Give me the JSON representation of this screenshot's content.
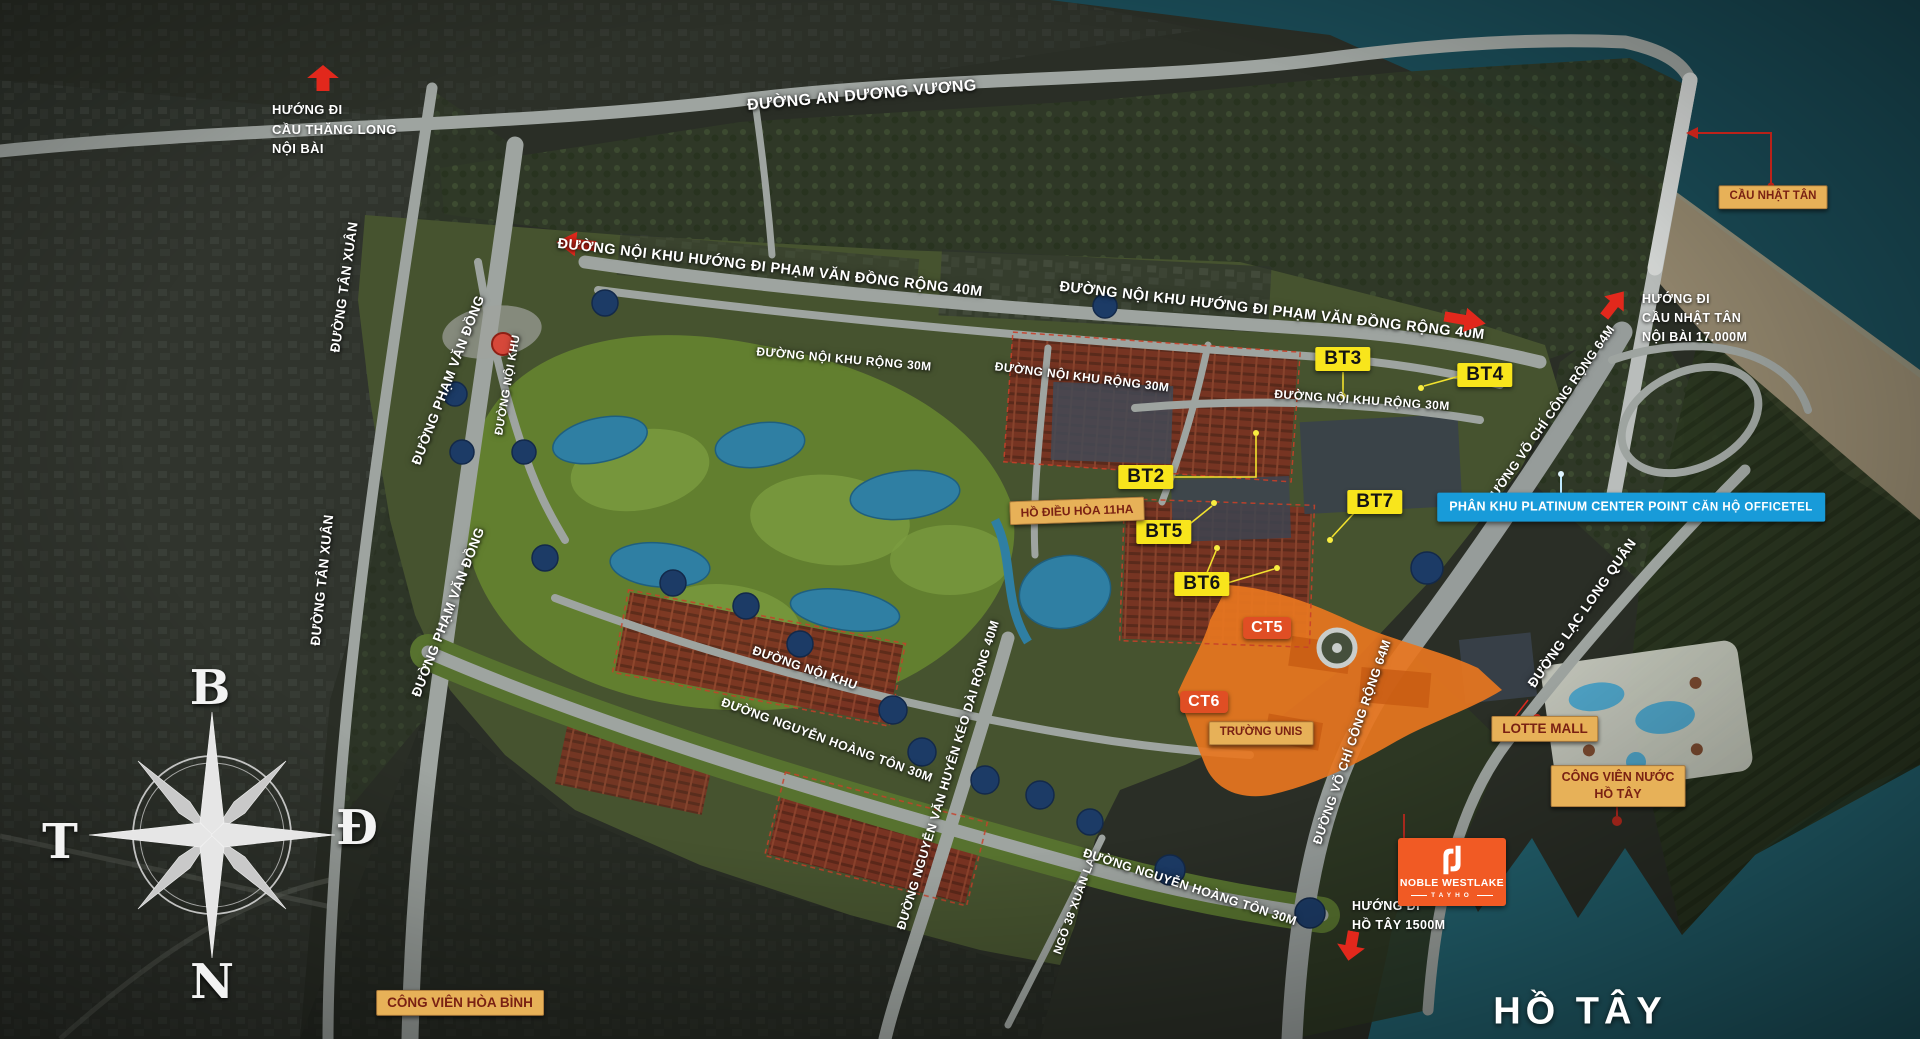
{
  "colors": {
    "badge_tan_bg": "#E7B158",
    "badge_tan_text": "#7A2113",
    "badge_yellow_bg": "#F8E51C",
    "badge_yellow_text": "#141414",
    "badge_blue_bg": "#189BD9",
    "badge_ct_bg": "#E04E24",
    "arrow_red": "#E2281C",
    "noble_orange": "#F15A24",
    "road_text": "#FFFFFF"
  },
  "compass": {
    "north": "B",
    "east": "Đ",
    "south": "N",
    "west": "T"
  },
  "directions": {
    "thang_long": {
      "line1": "HƯỚNG ĐI",
      "line2": "CẦU THĂNG LONG",
      "line3": "NỘI BÀI"
    },
    "nhat_tan": {
      "line1": "HƯỚNG ĐI",
      "line2": "CẦU NHẬT TÂN",
      "line3": "NỘI BÀI 17.000M"
    },
    "ho_tay": {
      "line1": "HƯỚNG ĐI",
      "line2": "HỒ TÂY 1500M"
    }
  },
  "roads": {
    "an_duong_vuong": "ĐƯỜNG AN DƯƠNG VƯƠNG",
    "noi_khu_40m_tay": "ĐƯỜNG NỘI KHU HƯỚNG ĐI PHẠM VĂN ĐỒNG RỘNG 40M",
    "noi_khu_40m_dong": "ĐƯỜNG NỘI KHU HƯỚNG ĐI PHẠM VĂN ĐỒNG RỘNG 40M",
    "noi_khu_30m_1": "ĐƯỜNG NỘI KHU RỘNG 30M",
    "noi_khu_30m_2": "ĐƯỜNG NỘI KHU RỘNG 30M",
    "noi_khu_30m_3": "ĐƯỜNG NỘI KHU RỘNG 30M",
    "tan_xuan_1": "ĐƯỜNG TÂN XUÂN",
    "tan_xuan_2": "ĐƯỜNG TÂN XUÂN",
    "pham_van_dong_1": "ĐƯỜNG PHẠM VĂN ĐỒNG",
    "pham_van_dong_2": "ĐƯỜNG PHẠM VĂN ĐỒNG",
    "noi_khu_doc": "ĐƯỜNG NỘI KHU",
    "noi_khu_nam": "ĐƯỜNG NỘI KHU",
    "nguyen_hoang_ton_1": "ĐƯỜNG NGUYỄN HOÀNG TÔN 30M",
    "nguyen_hoang_ton_2": "ĐƯỜNG NGUYỄN HOÀNG TÔN 30M",
    "nguyen_van_huyen": "ĐƯỜNG NGUYỄN VĂN HUYÊN KÉO DÀI RỘNG 40M",
    "ngo_38_xuan_la": "NGÕ 38 XUÂN LA",
    "vo_chi_cong_1": "ĐƯỜNG VÕ CHÍ CÔNG RỘNG 64M",
    "vo_chi_cong_2": "ĐƯỜNG VÕ CHÍ CÔNG RỘNG 64M",
    "lac_long_quan": "ĐƯỜNG LẠC LONG QUÂN"
  },
  "plots": {
    "bt2": "BT2",
    "bt3": "BT3",
    "bt4": "BT4",
    "bt5": "BT5",
    "bt6": "BT6",
    "bt7": "BT7",
    "ct5": "CT5",
    "ct6": "CT6"
  },
  "places": {
    "cau_nhat_tan": "CẦU NHẬT TÂN",
    "ho_dieu_hoa": "HỒ ĐIỀU HÒA 11HA",
    "platinum_line1": "PHÂN KHU PLATINUM CENTER POINT",
    "platinum_line2": "CĂN HỘ OFFICETEL",
    "truong_unis": "TRƯỜNG UNIS",
    "lotte_mall": "LOTTE MALL",
    "cv_nuoc_line1": "CÔNG VIÊN NƯỚC",
    "cv_nuoc_line2": "HỒ TÂY",
    "cv_hoa_binh": "CÔNG VIÊN HÒA BÌNH",
    "ho_tay": "HỒ TÂY"
  },
  "noble": {
    "brand": "NOBLE WESTLAKE",
    "sub": "TAYHO"
  }
}
